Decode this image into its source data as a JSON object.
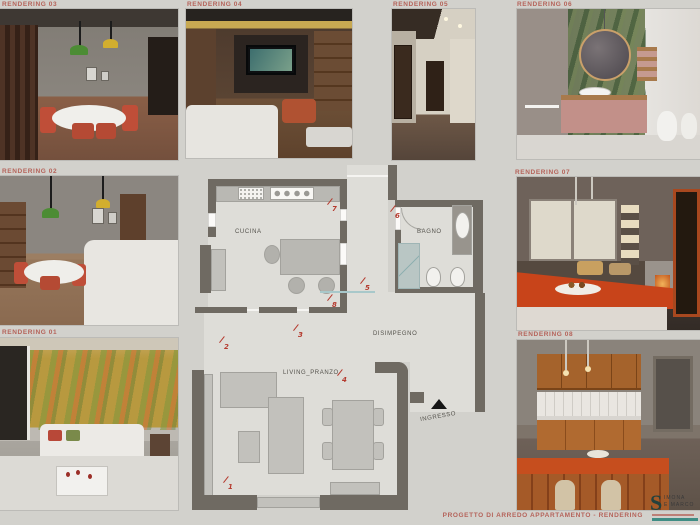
{
  "colors": {
    "background": "#d2d1cc",
    "accent_red": "#b5635a",
    "plan_wall": "#6f6a62",
    "marker_red": "#b53a2e",
    "shower_teal": "#b9c6c4",
    "logo_teal": "#3f8d84",
    "entrance_black": "#161616"
  },
  "renderings": [
    {
      "id": "01",
      "label": "RENDERING 01"
    },
    {
      "id": "02",
      "label": "RENDERING 02"
    },
    {
      "id": "03",
      "label": "RENDERING 03"
    },
    {
      "id": "04",
      "label": "RENDERING 04"
    },
    {
      "id": "05",
      "label": "RENDERING 05"
    },
    {
      "id": "06",
      "label": "RENDERING 06"
    },
    {
      "id": "07",
      "label": "RENDERING 07"
    },
    {
      "id": "08",
      "label": "RENDERING 08"
    }
  ],
  "floorplan": {
    "rooms": [
      {
        "name": "CUCINA"
      },
      {
        "name": "BAGNO"
      },
      {
        "name": "DISIMPEGNO"
      },
      {
        "name": "LIVING_PRANZO"
      },
      {
        "name": "INGRESSO"
      }
    ],
    "markers": [
      {
        "label": "1"
      },
      {
        "label": "2"
      },
      {
        "label": "3"
      },
      {
        "label": "4"
      },
      {
        "label": "5"
      },
      {
        "label": "6"
      },
      {
        "label": "7"
      },
      {
        "label": "8"
      }
    ]
  },
  "footer": {
    "title": "PROGETTO DI ARREDO APPARTAMENTO - RENDERING"
  },
  "logo": {
    "initial": "S",
    "line1": "IMONA",
    "line2": "E MARCO"
  }
}
